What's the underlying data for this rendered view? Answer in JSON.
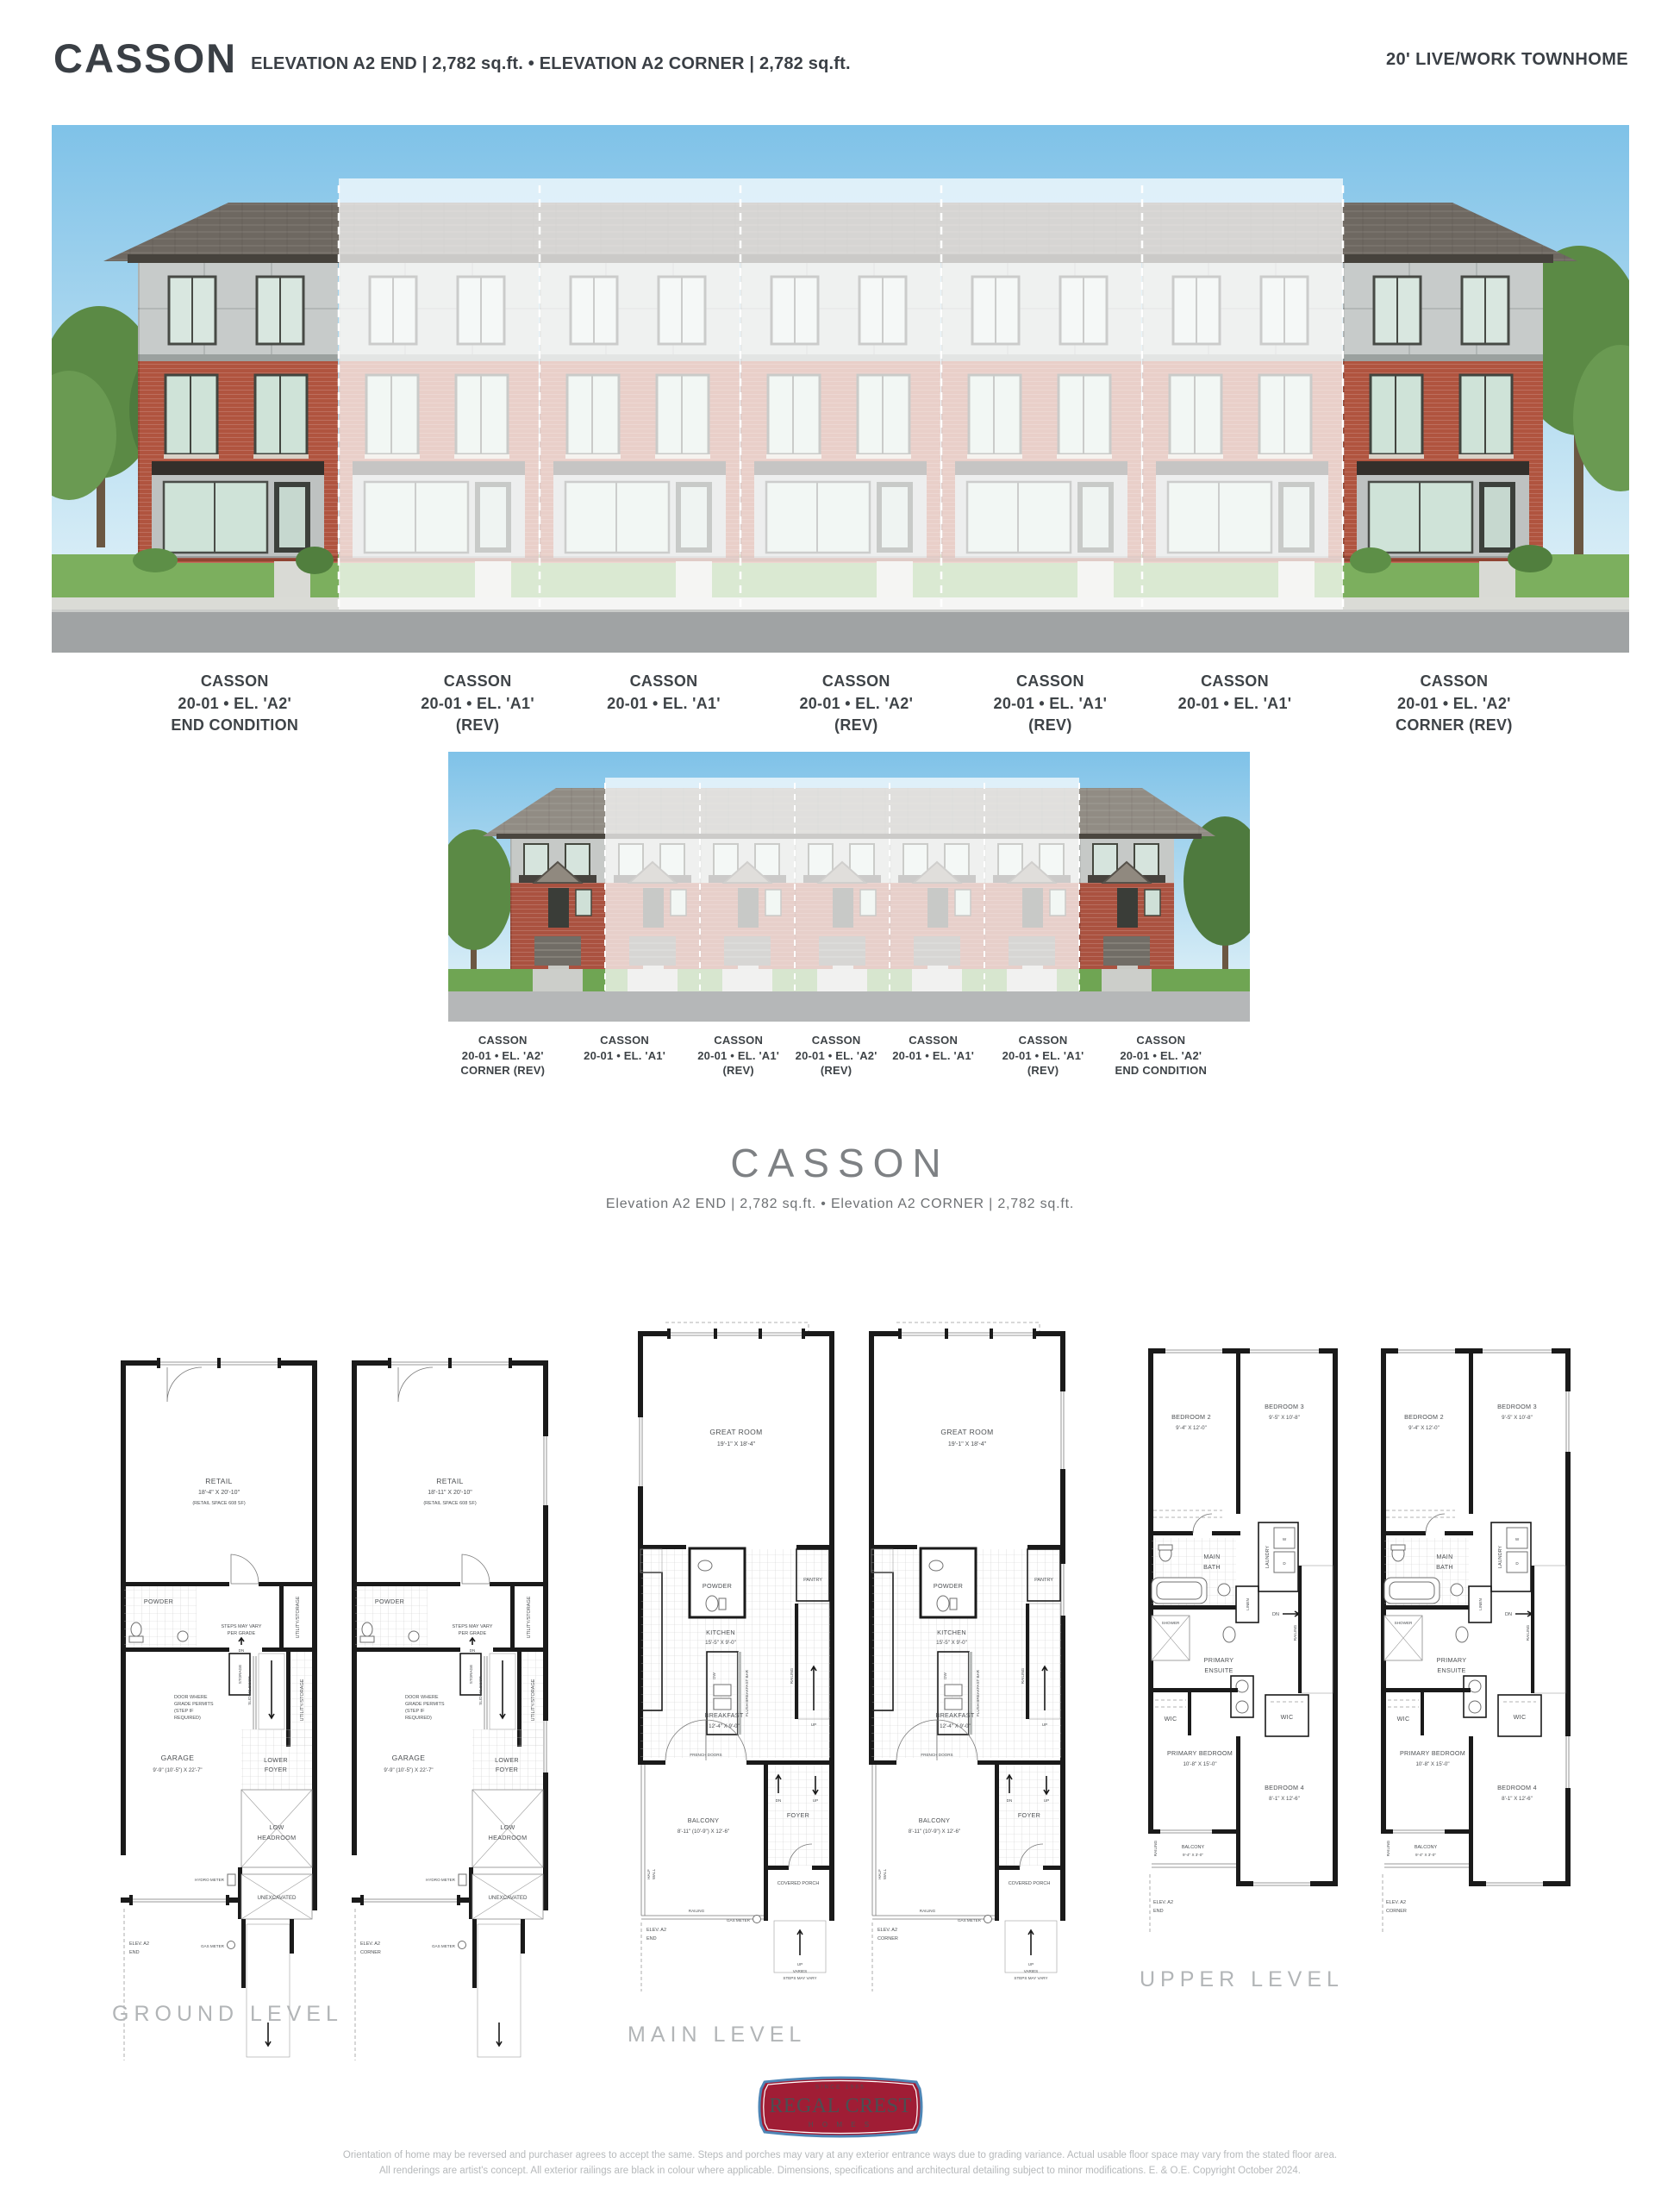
{
  "header": {
    "title": "CASSON",
    "subtitle": "ELEVATION A2 END  |  2,782 sq.ft.  •  ELEVATION A2 CORNER  |  2,782 sq.ft.",
    "type_label": "20' LIVE/WORK TOWNHOME"
  },
  "front_units": [
    {
      "name": "CASSON",
      "line2": "20-01 • EL. 'A2'",
      "line3": "END CONDITION"
    },
    {
      "name": "CASSON",
      "line2": "20-01 • EL. 'A1'",
      "line3": "(REV)"
    },
    {
      "name": "CASSON",
      "line2": "20-01 • EL. 'A1'",
      "line3": ""
    },
    {
      "name": "CASSON",
      "line2": "20-01 • EL. 'A2'",
      "line3": "(REV)"
    },
    {
      "name": "CASSON",
      "line2": "20-01 • EL. 'A1'",
      "line3": "(REV)"
    },
    {
      "name": "CASSON",
      "line2": "20-01 • EL. 'A1'",
      "line3": ""
    },
    {
      "name": "CASSON",
      "line2": "20-01 • EL. 'A2'",
      "line3": "CORNER (REV)"
    }
  ],
  "rear_units": [
    {
      "name": "CASSON",
      "line2": "20-01 • EL. 'A2'",
      "line3": "CORNER (REV)"
    },
    {
      "name": "CASSON",
      "line2": "20-01 • EL. 'A1'",
      "line3": ""
    },
    {
      "name": "CASSON",
      "line2": "20-01 • EL. 'A1'",
      "line3": "(REV)"
    },
    {
      "name": "CASSON",
      "line2": "20-01 • EL. 'A2'",
      "line3": "(REV)"
    },
    {
      "name": "CASSON",
      "line2": "20-01 • EL. 'A1'",
      "line3": ""
    },
    {
      "name": "CASSON",
      "line2": "20-01 • EL. 'A1'",
      "line3": "(REV)"
    },
    {
      "name": "CASSON",
      "line2": "20-01 • EL. 'A2'",
      "line3": "END CONDITION"
    }
  ],
  "mid": {
    "title": "CASSON",
    "subtitle": "Elevation A2 END  |  2,782 sq.ft.  •  Elevation A2 CORNER  |  2,782 sq.ft."
  },
  "levels": {
    "ground": "GROUND LEVEL",
    "main": "MAIN LEVEL",
    "upper": "UPPER LEVEL"
  },
  "plans": {
    "ground": {
      "retail": "RETAIL",
      "retail_dim_end": "18'-4\" X 20'-10\"",
      "retail_dim_corner": "18'-11\" X 20'-10\"",
      "retail_note": "(RETAIL SPACE 608 SF)",
      "powder": "POWDER",
      "utility": "UTILITY/STORAGE",
      "steps_note_1": "STEPS MAY VARY",
      "steps_note_2": "PER GRADE",
      "dn": "DN",
      "door_note_1": "DOOR WHERE",
      "door_note_2": "GRADE PERMITS",
      "door_note_3": "(STEP IF",
      "door_note_4": "REQUIRED)",
      "garage": "GARAGE",
      "garage_dim": "9'-9\" (10'-5\") X 22'-7\"",
      "storage": "STORAGE",
      "sliding_door": "SLIDING DOOR",
      "lower_foyer_1": "LOWER",
      "lower_foyer_2": "FOYER",
      "low_headroom_1": "LOW",
      "low_headroom_2": "HEADROOM",
      "unexcavated": "UNEXCAVATED",
      "hydro_meter": "HYDRO METER",
      "gas_meter": "GAS METER",
      "elev_line1": "ELEV. A2",
      "elev_end": "END",
      "elev_corner": "CORNER"
    },
    "main": {
      "great_room": "GREAT ROOM",
      "great_room_dim": "19'-1\" X 18'-4\"",
      "powder": "POWDER",
      "pantry": "PANTRY",
      "kitchen": "KITCHEN",
      "kitchen_dim": "15'-5\" X 9'-0\"",
      "dw": "DW",
      "flush_bar": "FLUSH BREAKFAST BAR",
      "railing": "RAILING",
      "up": "UP",
      "dn": "DN",
      "breakfast": "BREAKFAST",
      "breakfast_dim": "12'-4\" X 9'-0\"",
      "french_doors": "FRENCH DOORS",
      "balcony": "BALCONY",
      "balcony_dim": "8'-11\" (10'-9\") X 12'-6\"",
      "half_wall_1": "HALF",
      "half_wall_2": "WALL",
      "foyer": "FOYER",
      "covered_porch": "COVERED PORCH",
      "gas_meter": "GAS METER",
      "steps_up": "UP",
      "steps_varies": "VARIES",
      "steps_may_vary": "STEPS MAY VARY",
      "elev_line1": "ELEV. A2",
      "elev_end": "END",
      "elev_corner": "CORNER"
    },
    "upper": {
      "bedroom2": "BEDROOM 2",
      "bedroom2_dim": "9'-4\" X 12'-0\"",
      "bedroom3": "BEDROOM 3",
      "bedroom3_dim": "9'-5\" X 10'-8\"",
      "main_bath_1": "MAIN",
      "main_bath_2": "BATH",
      "laundry": "LAUNDRY",
      "linen": "LINEN",
      "w": "W",
      "d": "D",
      "shower": "SHOWER",
      "ensuite_1": "PRIMARY",
      "ensuite_2": "ENSUITE",
      "wic": "WIC",
      "dn": "DN",
      "railing": "RAILING",
      "primary_bedroom": "PRIMARY BEDROOM",
      "primary_bedroom_dim": "10'-8\" X 15'-0\"",
      "bedroom4": "BEDROOM 4",
      "bedroom4_dim": "8'-1\" X 12'-6\"",
      "balcony": "BALCONY",
      "balcony_dim": "9'-4\" X 3'-0\"",
      "elev_line1": "ELEV. A2",
      "elev_end": "END",
      "elev_corner": "CORNER"
    }
  },
  "logo": {
    "since": "SINCE 1965",
    "name": "REGAL CREST",
    "homes": "H O M E S"
  },
  "disclaimer": {
    "line1": "Orientation of home may be reversed and purchaser agrees to accept the same. Steps and porches may vary at any exterior entrance ways due to grading variance. Actual usable floor space may vary from the stated floor area.",
    "line2": "All renderings are artist's concept. All exterior railings are black in colour where applicable. Dimensions, specifications and architectural detailing subject to minor modifications. E. & O.E. Copyright October 2024."
  },
  "colors": {
    "brick": "#b0543f",
    "roof": "#6e6861",
    "logo_red": "#a01d35",
    "logo_blue": "#4e86b6",
    "fade": "rgba(255,255,255,0.72)"
  }
}
